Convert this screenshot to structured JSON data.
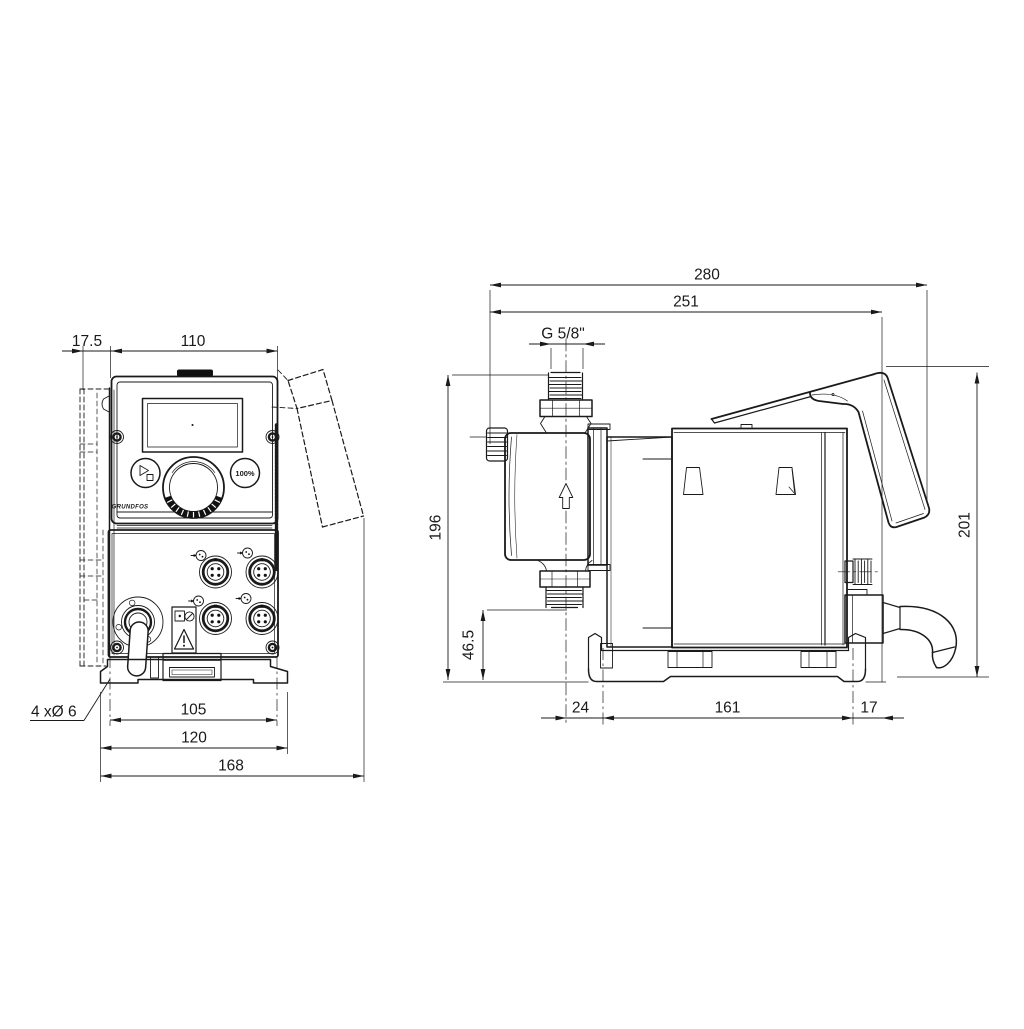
{
  "colors": {
    "line": "#1a1a1a",
    "dark_fill": "#111111",
    "background": "#ffffff"
  },
  "front_view": {
    "dim_offset": "17.5",
    "dim_width": "110",
    "dim_hole_spacing": "105",
    "dim_foot_width": "120",
    "dim_overall_width": "168",
    "note_holes": "4 xØ 6",
    "panel": {
      "button_100": "100%",
      "logo": "GRUNDFOS"
    }
  },
  "side_view": {
    "dim_overall_depth": "280",
    "dim_hood_depth": "251",
    "dim_thread": "G 5/8\"",
    "dim_height": "196",
    "dim_outlet_height": "46.5",
    "dim_total_height": "201",
    "dim_front_offset": "24",
    "dim_base_holes": "161",
    "dim_rear_offset": "17"
  }
}
